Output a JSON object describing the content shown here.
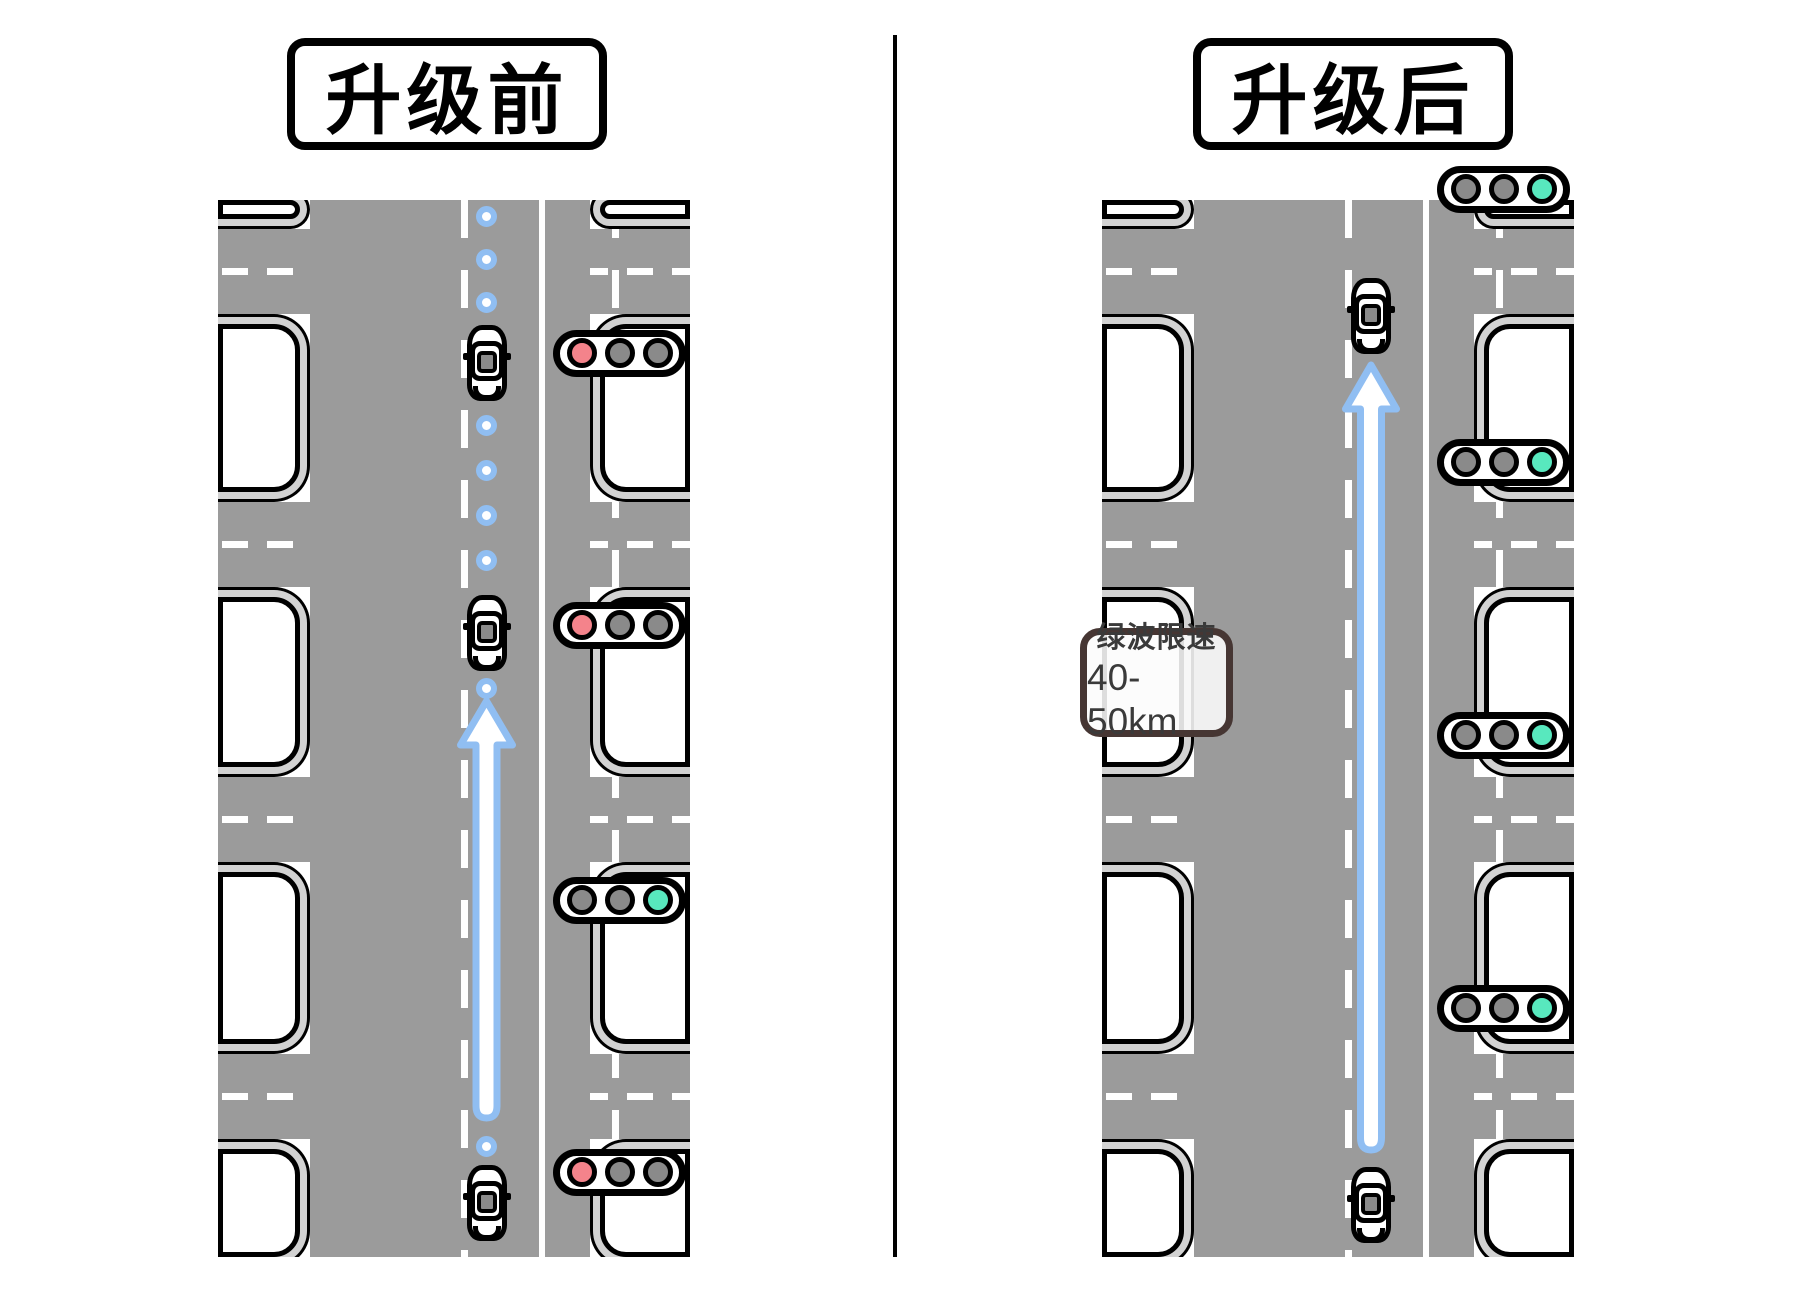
{
  "panels": {
    "before": {
      "title": "升级前",
      "car_count": 3,
      "path_style": "dotted-path-with-stops",
      "lights": [
        {
          "state": "red",
          "bulbs": [
            "#F4838B",
            "#8A8A8A",
            "#8A8A8A"
          ]
        },
        {
          "state": "red",
          "bulbs": [
            "#F4838B",
            "#8A8A8A",
            "#8A8A8A"
          ]
        },
        {
          "state": "green",
          "bulbs": [
            "#8A8A8A",
            "#8A8A8A",
            "#58E8BE"
          ]
        },
        {
          "state": "red",
          "bulbs": [
            "#F4838B",
            "#8A8A8A",
            "#8A8A8A"
          ]
        }
      ]
    },
    "after": {
      "title": "升级后",
      "car_count": 2,
      "path_style": "continuous-arrow",
      "speed_sign": {
        "line1": "绿波限速",
        "line2": "40-50km"
      },
      "lights": [
        {
          "state": "green",
          "bulbs": [
            "#8A8A8A",
            "#8A8A8A",
            "#58E8BE"
          ]
        },
        {
          "state": "green",
          "bulbs": [
            "#8A8A8A",
            "#8A8A8A",
            "#58E8BE"
          ]
        },
        {
          "state": "green",
          "bulbs": [
            "#8A8A8A",
            "#8A8A8A",
            "#58E8BE"
          ]
        },
        {
          "state": "green",
          "bulbs": [
            "#8A8A8A",
            "#8A8A8A",
            "#58E8BE"
          ]
        }
      ]
    }
  },
  "colors": {
    "road_gray": "#9B9B9B",
    "sidewalk_gray": "#D2D2D2",
    "red_light": "#F4838B",
    "green_light": "#58E8BE",
    "off_light": "#8A8A8A",
    "path_blue": "#90BEF2"
  }
}
